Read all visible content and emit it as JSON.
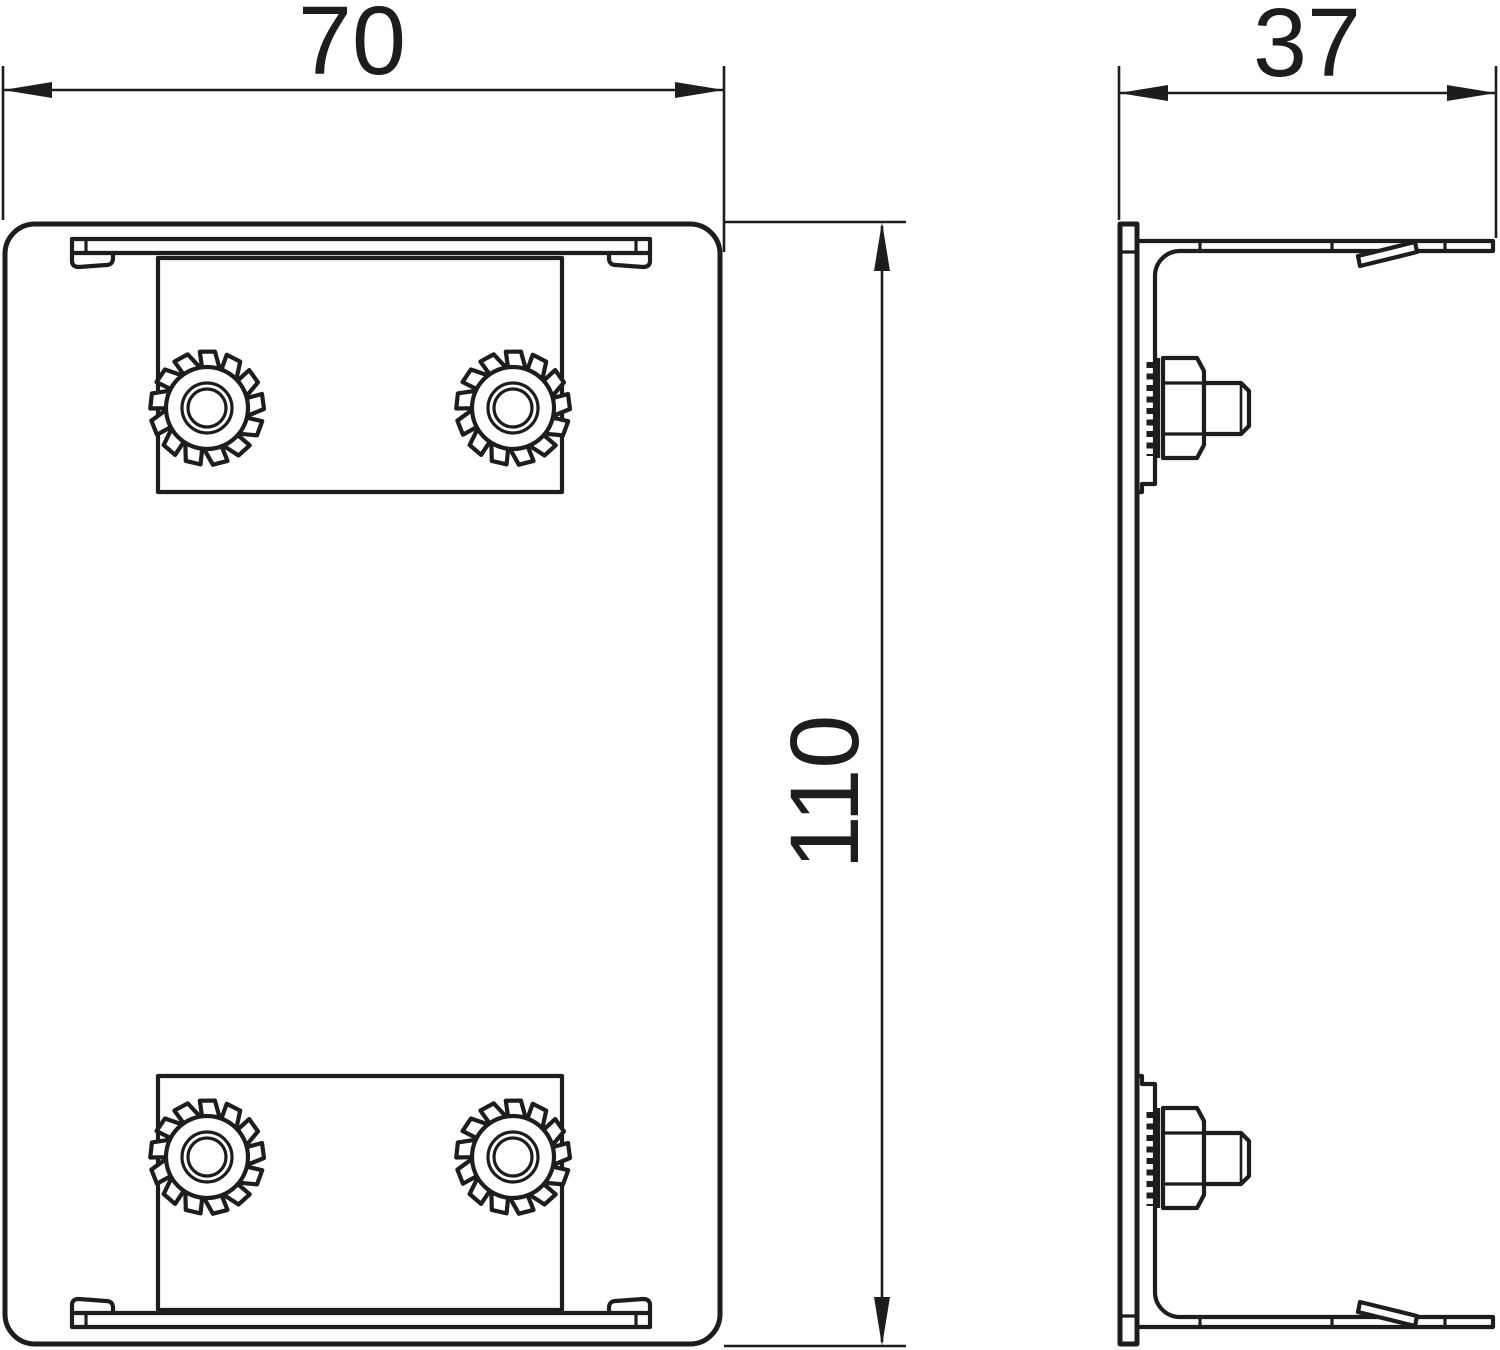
{
  "drawing": {
    "dimensions": {
      "width": "70",
      "depth": "37",
      "height": "110"
    },
    "line_color": "#1d1d1b"
  }
}
